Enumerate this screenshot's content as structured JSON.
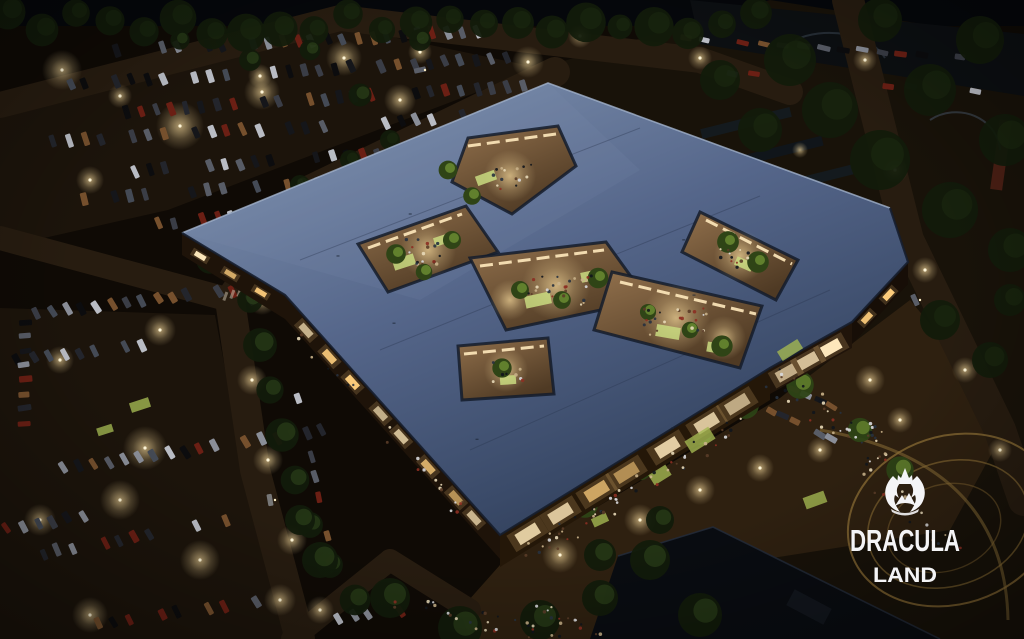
{
  "scene": {
    "title": "Aerial night rendering of Dracula Land retail complex",
    "watermark": {
      "brand": "DRACULA",
      "sub": "LAND",
      "icon": "bat-castle-emblem",
      "color": "#f4f4f6"
    },
    "palette": {
      "night_base": "#0f0a05",
      "sky": "#05070b",
      "tree_dark": "#121b0b",
      "tree_lit": "#3c5520",
      "roof_light": "#8295b2",
      "roof_mid": "#55668a",
      "roof_dark": "#2b374f",
      "roof_edge": "#a3b3cc",
      "court_floor": "#7c5d3e",
      "court_glow": "#ffd98f",
      "window_glow": "#ffcf7d",
      "storefront": "#ffe9bc",
      "lawn": "#a3b751",
      "lawn_lit": "#c9db80",
      "asphalt": "#1c140b",
      "asphalt_lit": "#3c2c17",
      "road": "#271c10",
      "wall": "#1e1309",
      "plaza": "#2e2010",
      "adjacent_roof": "#090c11",
      "coaster": "#8d6f36",
      "light_warm": "#ffe2a2",
      "white": "#f4f4f6"
    }
  }
}
